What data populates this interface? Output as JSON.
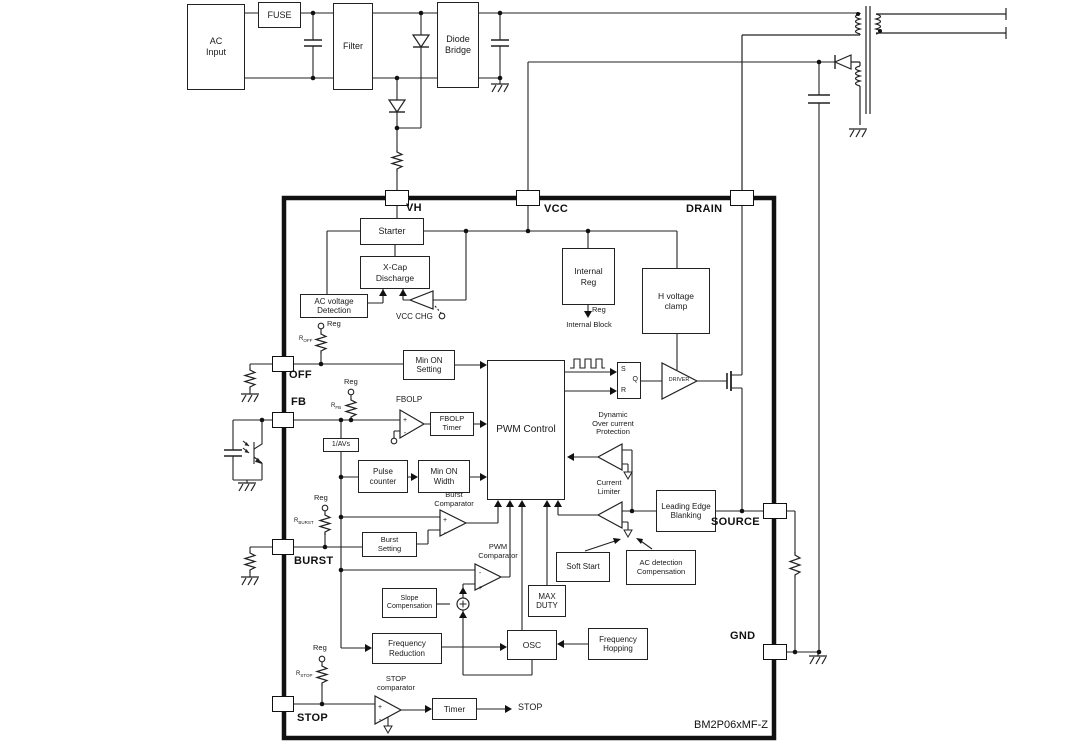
{
  "part_number": "BM2P06xMF-Z",
  "symbols": {
    "plus": "+",
    "minus": "-"
  },
  "external": {
    "ac_input": "AC\nInput",
    "fuse": "FUSE",
    "filter": "Filter",
    "diode_bridge": "Diode\nBridge"
  },
  "pins": {
    "vh": "VH",
    "vcc": "VCC",
    "drain": "DRAIN",
    "off": "OFF",
    "fb": "FB",
    "burst": "BURST",
    "stop": "STOP",
    "source": "SOURCE",
    "gnd": "GND"
  },
  "blocks": {
    "starter": "Starter",
    "xcap": "X-Cap\nDischarge",
    "acv_det": "AC voltage\nDetection",
    "internal_reg": "Internal\nReg",
    "h_clamp": "H voltage\nclamp",
    "min_on_setting": "Min ON\nSetting",
    "pwm_control": "PWM Control",
    "fbolp_timer": "FBOLP\nTimer",
    "avs": "1/AVs",
    "pulse_counter": "Pulse\ncounter",
    "min_on_width": "Min ON\nWidth",
    "burst_setting": "Burst\nSetting",
    "slope_comp": "Slope\nCompensation",
    "max_duty": "MAX\nDUTY",
    "soft_start": "Soft Start",
    "ac_det_comp": "AC detection\nCompensation",
    "leb": "Leading Edge\nBlanking",
    "freq_reduction": "Frequency\nReduction",
    "osc": "OSC",
    "freq_hopping": "Frequency\nHopping",
    "timer": "Timer"
  },
  "comparators": {
    "fbolp": "FBOLP",
    "vcc_chg": "VCC CHG",
    "burst": "Burst\nComparator",
    "pwm": "PWM\nComparator",
    "current_limiter": "Current\nLimiter",
    "docp": "Dynamic\nOver current\nProtection",
    "stop": "STOP\ncomparator",
    "driver": "DRIVER"
  },
  "latch": {
    "s": "S",
    "r": "R",
    "q": "Q"
  },
  "labels": {
    "reg": "Reg",
    "internal_block": "Internal Block",
    "stop_out": "STOP",
    "r_base": "R",
    "r_off_sub": "OFF",
    "r_fb_sub": "FB",
    "r_burst_sub": "BURST",
    "r_stop_sub": "STOP"
  }
}
